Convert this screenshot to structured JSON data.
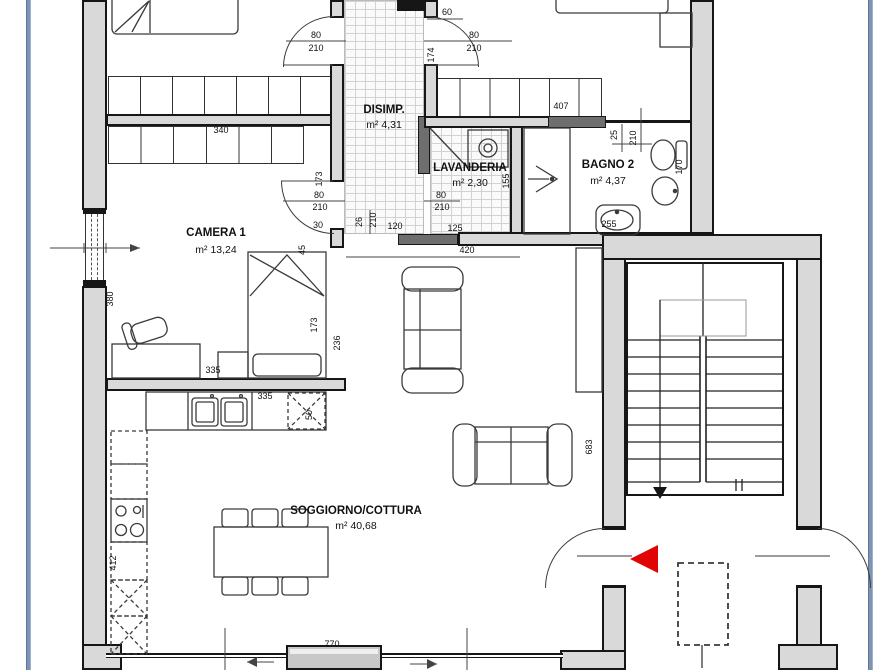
{
  "plan_title": "apartment-floor-plan",
  "colors": {
    "wall_fill": "#d9d9d9",
    "threshold_dark": "#6e6e6e",
    "frame_blue": "#7d94b5",
    "entrance_marker_red": "#e00404"
  },
  "rooms": [
    {
      "id": "disimp",
      "name": "DISIMP.",
      "area": "m² 4,31"
    },
    {
      "id": "lavanderia",
      "name": "LAVANDERIA",
      "area": "m² 2,30"
    },
    {
      "id": "bagno2",
      "name": "BAGNO 2",
      "area": "m² 4,37"
    },
    {
      "id": "camera1",
      "name": "CAMERA 1",
      "area": "m² 13,24"
    },
    {
      "id": "soggiorno",
      "name": "SOGGIORNO/COTTURA",
      "area": "m² 40,68"
    }
  ],
  "doors": [
    {
      "id": "door-top-left",
      "width": "80",
      "height": "210"
    },
    {
      "id": "door-top-right",
      "width": "80",
      "height": "210"
    },
    {
      "id": "door-camera1",
      "width": "80",
      "height": "210"
    },
    {
      "id": "door-lavanderia",
      "width": "80",
      "height": "210"
    },
    {
      "id": "door-bagno2",
      "width": "25",
      "height": "210"
    }
  ],
  "dimensions": {
    "d340": "340",
    "d60": "60",
    "d174": "174",
    "d407": "407",
    "d170": "170",
    "d255": "255",
    "d155": "155",
    "d173_wall": "173",
    "d173_bed": "173",
    "d236": "236",
    "d30": "30",
    "d26": "26",
    "d210_disimp": "210",
    "d120": "120",
    "d125": "125",
    "d45": "45",
    "d420": "420",
    "d683": "683",
    "d412": "412",
    "d50": "50",
    "d335_bed": "335",
    "d335_counter": "335",
    "d380": "380",
    "d770": "770"
  }
}
